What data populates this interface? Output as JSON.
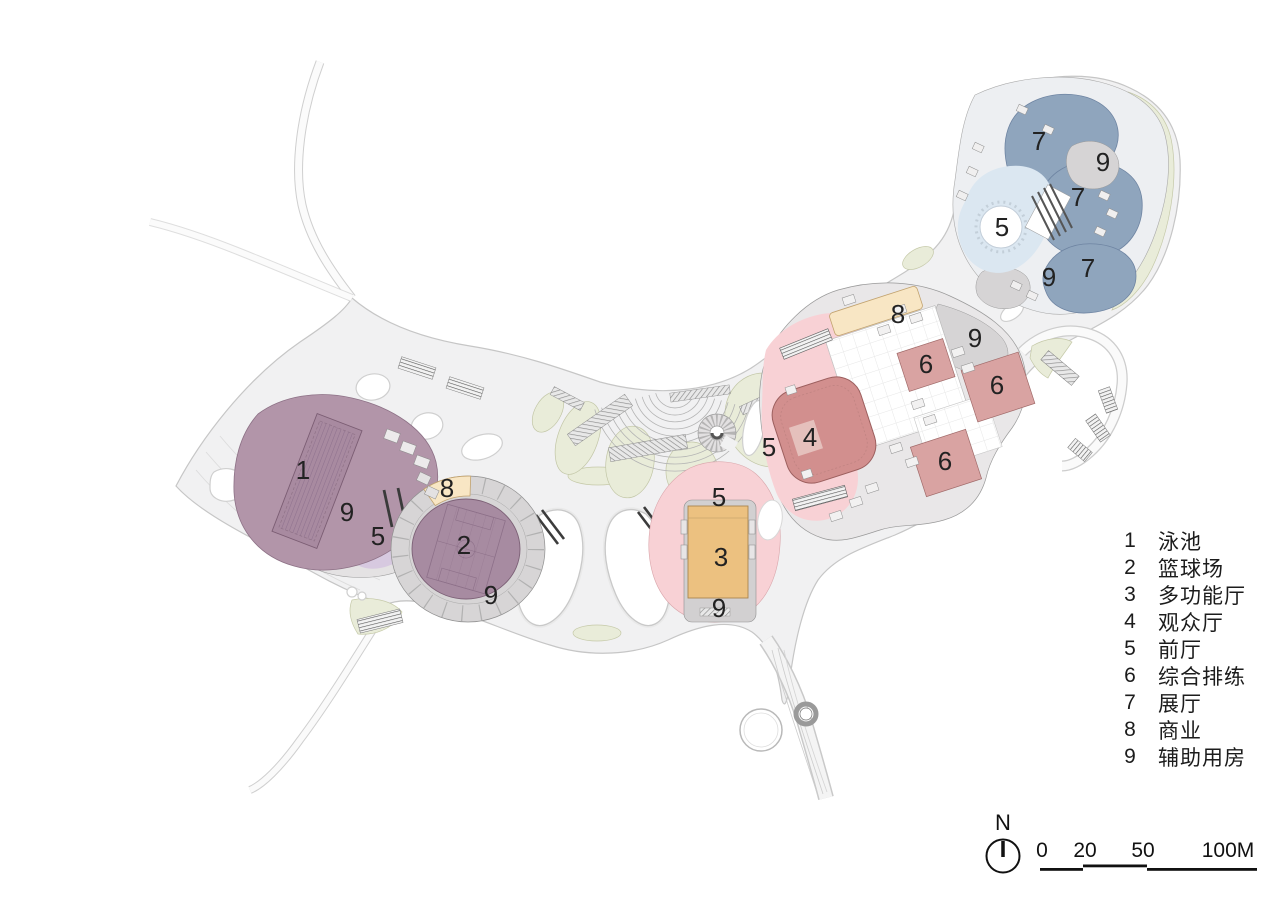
{
  "legend": {
    "items": [
      {
        "num": "1",
        "label": "泳池"
      },
      {
        "num": "2",
        "label": "篮球场"
      },
      {
        "num": "3",
        "label": "多功能厅"
      },
      {
        "num": "4",
        "label": "观众厅"
      },
      {
        "num": "5",
        "label": "前厅"
      },
      {
        "num": "6",
        "label": "综合排练"
      },
      {
        "num": "7",
        "label": "展厅"
      },
      {
        "num": "8",
        "label": "商业"
      },
      {
        "num": "9",
        "label": "辅助用房"
      }
    ]
  },
  "plan": {
    "markers": [
      {
        "num": "1"
      },
      {
        "num": "9"
      },
      {
        "num": "5"
      },
      {
        "num": "8"
      },
      {
        "num": "2"
      },
      {
        "num": "9"
      },
      {
        "num": "5"
      },
      {
        "num": "3"
      },
      {
        "num": "9"
      },
      {
        "num": "5"
      },
      {
        "num": "4"
      },
      {
        "num": "8"
      },
      {
        "num": "9"
      },
      {
        "num": "6"
      },
      {
        "num": "6"
      },
      {
        "num": "6"
      },
      {
        "num": "7"
      },
      {
        "num": "9"
      },
      {
        "num": "7"
      },
      {
        "num": "5"
      },
      {
        "num": "9"
      },
      {
        "num": "7"
      }
    ]
  },
  "north": {
    "label": "N"
  },
  "scale_bar": {
    "tick0": "0",
    "tick1": "20",
    "tick2": "50",
    "tick3": "100M"
  },
  "colors": {
    "plaza": "#f1f1f2",
    "pool_hall": "#b295a9",
    "pool": "#a88aa0",
    "court_hall": "#a78ba1",
    "foyer_west": "#d7c9e0",
    "commercial": "#f8e6c4",
    "multi_hall": "#ecc180",
    "theater_foyer": "#f8d1d5",
    "audience": "#d28f8e",
    "rehearsal": "#d9a3a2",
    "exhibition": "#8fa5bd",
    "exhibition_foyer": "#dbe7f1",
    "auxiliary": "#d6d4d5",
    "landscape_green": "#e9ecd9"
  }
}
